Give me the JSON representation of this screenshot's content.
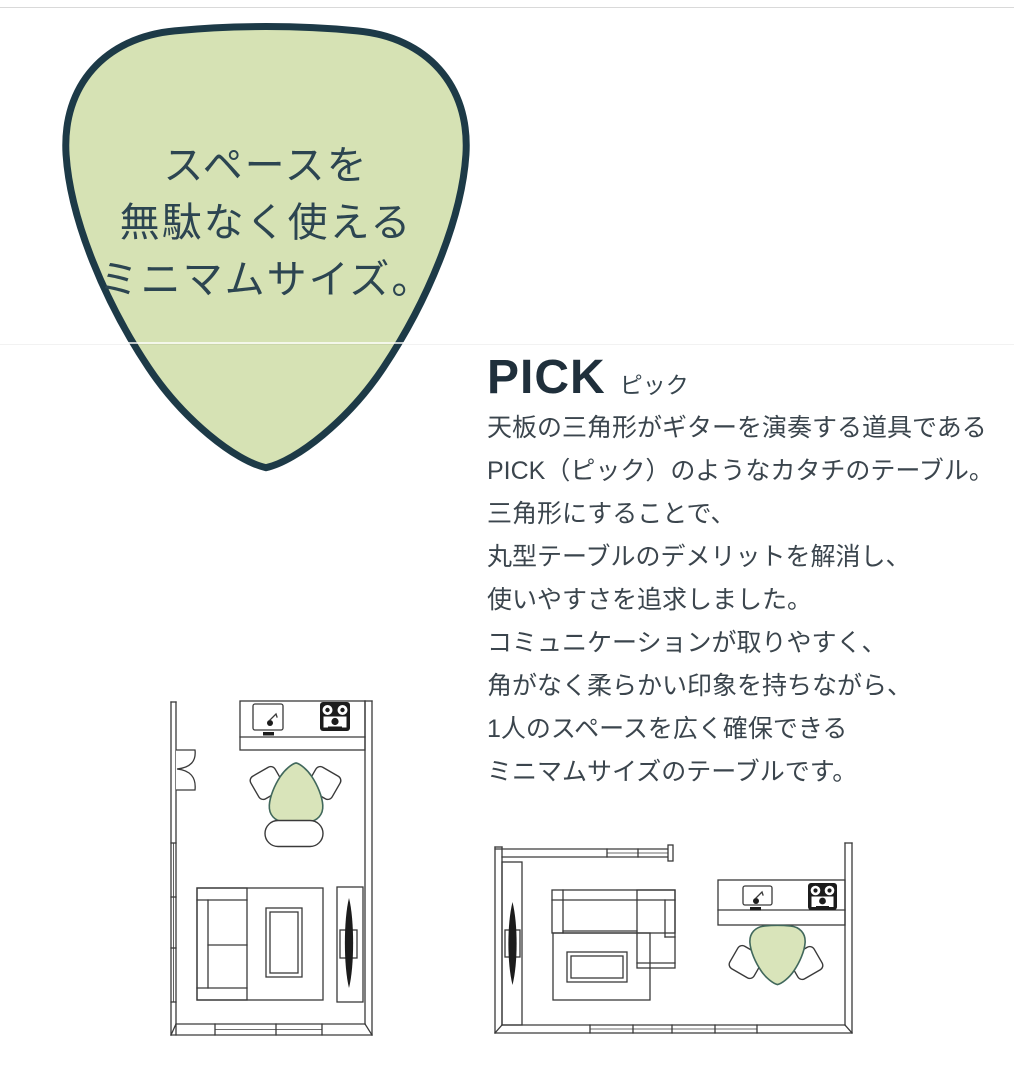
{
  "page": {
    "background": "#ffffff",
    "top_border_color": "#d9d9d9"
  },
  "hero": {
    "shape": "guitar-pick",
    "lines": [
      "スペースを",
      "無駄なく使える",
      "ミニマムサイズ。"
    ],
    "fill": "#d6e2b4",
    "outline": "#1d3a47",
    "text_color": "#2c4551"
  },
  "product": {
    "title": "PICK",
    "title_kana": "ピック",
    "title_color": "#1f2f3b",
    "kana_color": "#37454e",
    "text_color": "#3b454d",
    "description": "天板の三角形がギターを演奏する道具である\nPICK（ピック）のようなカタチのテーブル。\n三角形にすることで、\n丸型テーブルのデメリットを解消し、\n使いやすさを追求しました。\nコミュニケーションが取りやすく、\n角がなく柔らかい印象を持ちながら、\n1人のスペースを広く確保できる\nミニマムサイズのテーブルです。"
  },
  "floorplans": {
    "line_color": "#3a3a3a",
    "table_fill": "#d9e4ba",
    "table_outline": "#41685c",
    "left_plan": {
      "orientation": "vertical",
      "elements": [
        "door",
        "windows",
        "kitchen-counter",
        "sink",
        "stove",
        "pick-table",
        "chair",
        "chair",
        "bench",
        "sofa",
        "rug",
        "coffee-table",
        "tv-board"
      ]
    },
    "right_plan": {
      "orientation": "horizontal",
      "elements": [
        "tv-board",
        "sofa",
        "rug",
        "coffee-table",
        "windows",
        "kitchen-counter",
        "sink",
        "stove",
        "pick-table",
        "chair",
        "chair"
      ]
    }
  }
}
